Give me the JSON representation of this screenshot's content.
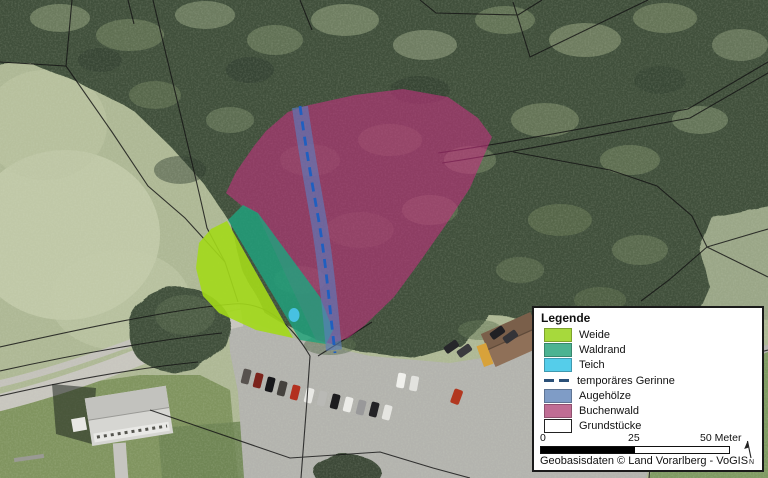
{
  "map": {
    "attribution": "Geobasisdaten © Land Vorarlberg - VoGIS",
    "north_label": "N",
    "scale_bar": {
      "start": "0",
      "mid": "25",
      "end": "50 Meter",
      "unit": "Meter"
    }
  },
  "legend": {
    "title": "Legende",
    "items": [
      {
        "label": "Weide",
        "color": "#a7d93c",
        "type": "fill"
      },
      {
        "label": "Waldrand",
        "color": "#4cb392",
        "type": "fill"
      },
      {
        "label": "Teich",
        "color": "#55cdea",
        "type": "fill"
      },
      {
        "label": "temporäres Gerinne",
        "color": "#2b5078",
        "type": "dashed-line"
      },
      {
        "label": "Augehölze",
        "color": "#7f9cc6",
        "type": "fill"
      },
      {
        "label": "Buchenwald",
        "color": "#c06d94",
        "type": "fill"
      },
      {
        "label": "Grundstücke",
        "color": "#ffffff",
        "type": "outline"
      }
    ]
  }
}
